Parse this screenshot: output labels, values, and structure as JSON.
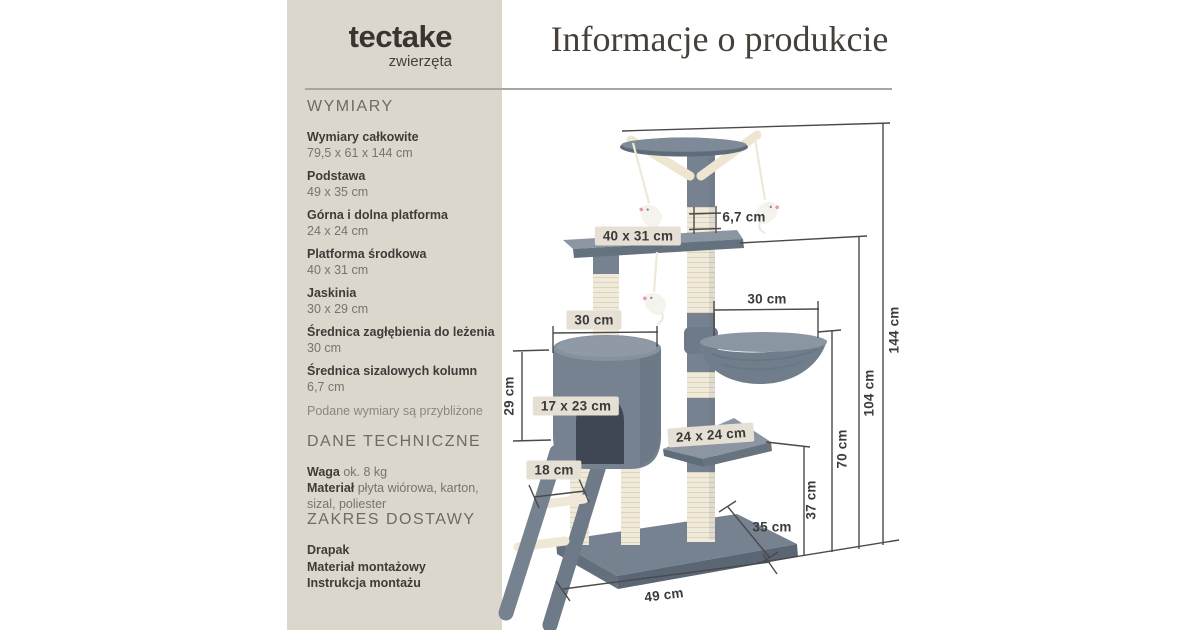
{
  "logo": {
    "name": "tectake",
    "tagline": "zwierzęta"
  },
  "header": {
    "title": "Informacje o produkcie"
  },
  "sidebar": {
    "dimensions": {
      "heading": "WYMIARY",
      "items": [
        {
          "label": "Wymiary całkowite",
          "value": "79,5 x 61 x 144 cm"
        },
        {
          "label": "Podstawa",
          "value": "49 x 35 cm"
        },
        {
          "label": "Górna i dolna platforma",
          "value": "24 x 24 cm"
        },
        {
          "label": "Platforma środkowa",
          "value": "40 x 31 cm"
        },
        {
          "label": "Jaskinia",
          "value": "30 x 29 cm"
        },
        {
          "label": "Średnica zagłębienia do leżenia",
          "value": "30 cm"
        },
        {
          "label": "Średnica sizalowych kolumn",
          "value": "6,7 cm"
        }
      ],
      "note": "Podane wymiary są przybliżone"
    },
    "technical": {
      "heading": "DANE TECHNICZNE",
      "rows": [
        {
          "label": "Waga",
          "value": "ok. 8 kg"
        },
        {
          "label": "Materiał",
          "value": "płyta wiórowa, karton, sizal, poliester"
        }
      ]
    },
    "delivery": {
      "heading": "ZAKRES DOSTAWY",
      "items": [
        "Drapak",
        "Materiał montażowy",
        "Instrukcja montażu"
      ]
    }
  },
  "diagram": {
    "annotations": {
      "column_diameter": "6,7 cm",
      "middle_platform": "40 x 31 cm",
      "cave_width": "30 cm",
      "basket_width": "30 cm",
      "cave_height": "29 cm",
      "cave_door": "17 x 23 cm",
      "ladder_rung": "18 cm",
      "small_platform": "24 x 24 cm",
      "base_depth": "35 cm",
      "base_width": "49 cm",
      "height_37": "37 cm",
      "height_70": "70 cm",
      "height_104": "104 cm",
      "height_144": "144 cm"
    },
    "colors": {
      "panel_beige": "#DBD7CC",
      "label_beige": "#E5E0D3",
      "plush_gray": "#76828F",
      "sisal_cream": "#F0EADA"
    }
  }
}
